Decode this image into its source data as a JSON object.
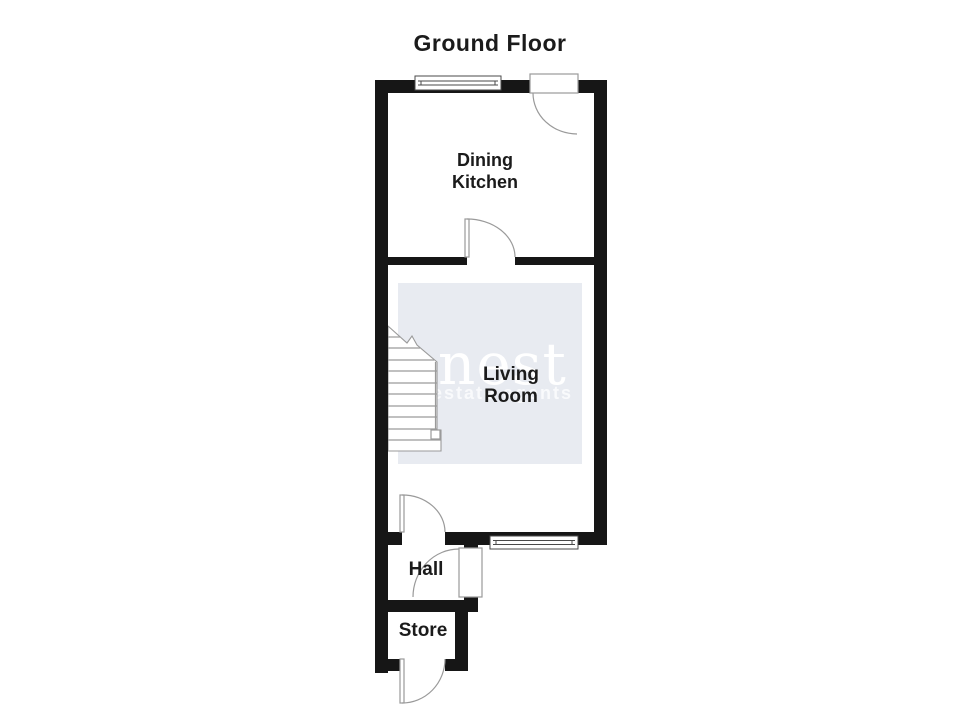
{
  "title": "Ground Floor",
  "floor_plan": {
    "rooms": [
      {
        "name": "Dining Kitchen",
        "label_lines": [
          "Dining",
          "Kitchen"
        ]
      },
      {
        "name": "Living Room",
        "label_lines": [
          "Living",
          "Room"
        ]
      },
      {
        "name": "Hall",
        "label_lines": [
          "Hall"
        ]
      },
      {
        "name": "Store",
        "label_lines": [
          "Store"
        ]
      }
    ],
    "symbols": [
      "window-top",
      "window-living-bottom",
      "door-entry-top",
      "door-dining-to-living",
      "door-living-to-hall",
      "door-hall-side",
      "door-store-front",
      "staircase"
    ]
  },
  "watermark": {
    "brand": "nest",
    "tagline": "estate agents"
  },
  "colors": {
    "wall": "#161616",
    "line": "#9a9a9a",
    "window_line": "#4a4a4a",
    "watermark_bg": "#e8ebf1",
    "text": "#1b1b1b",
    "background": "#ffffff"
  }
}
